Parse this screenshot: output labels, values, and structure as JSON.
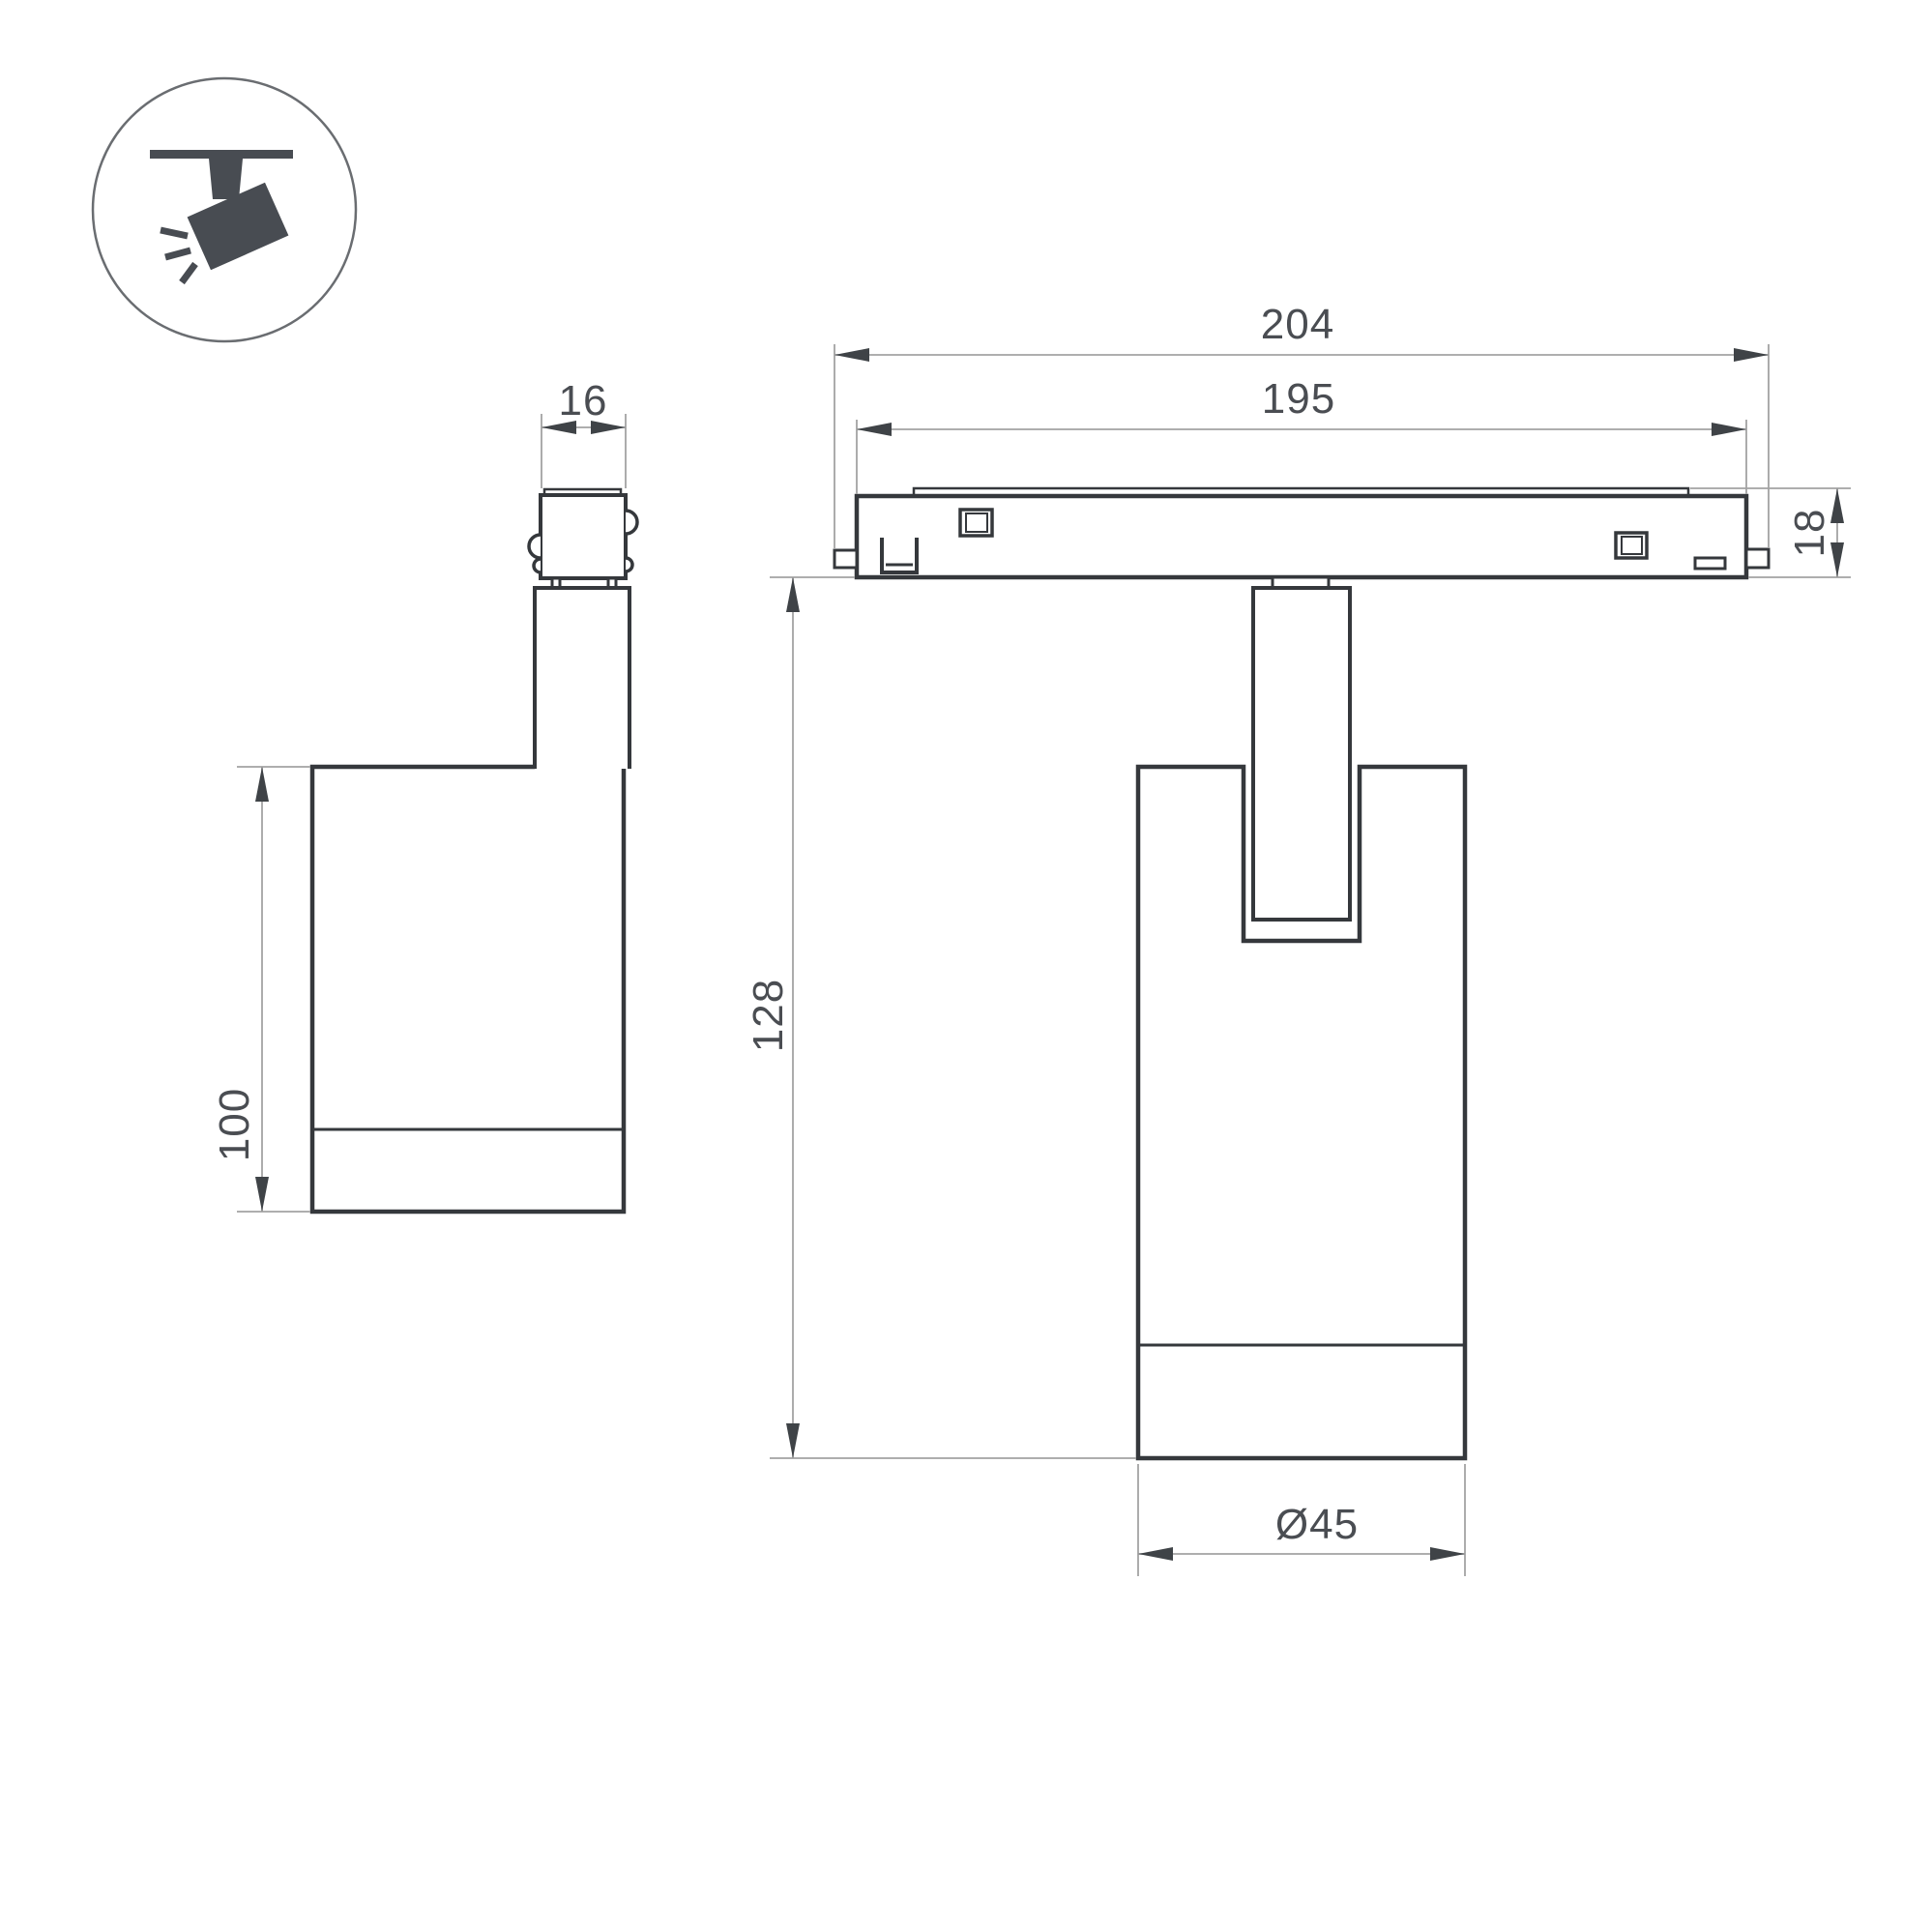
{
  "drawing": {
    "kind": "technical-dimension-drawing",
    "product": "track-mounted spotlight"
  },
  "colors": {
    "background": "#ffffff",
    "object_line": "#35383c",
    "dimension_line": "#a3a3a3",
    "arrow_fill": "#3f4347",
    "text": "#4a4d52",
    "icon_fill": "#484c52",
    "icon_circle_stroke": "#6a6d71"
  },
  "icon": {
    "label": "ceiling-track-spotlight-pictogram"
  },
  "dims": {
    "connector_width": {
      "label": "16"
    },
    "body_height": {
      "label": "100"
    },
    "track_overall_width": {
      "label": "204"
    },
    "track_body_width": {
      "label": "195"
    },
    "track_height": {
      "label": "18"
    },
    "overall_height": {
      "label": "128"
    },
    "diameter": {
      "label": "Ø45"
    }
  }
}
